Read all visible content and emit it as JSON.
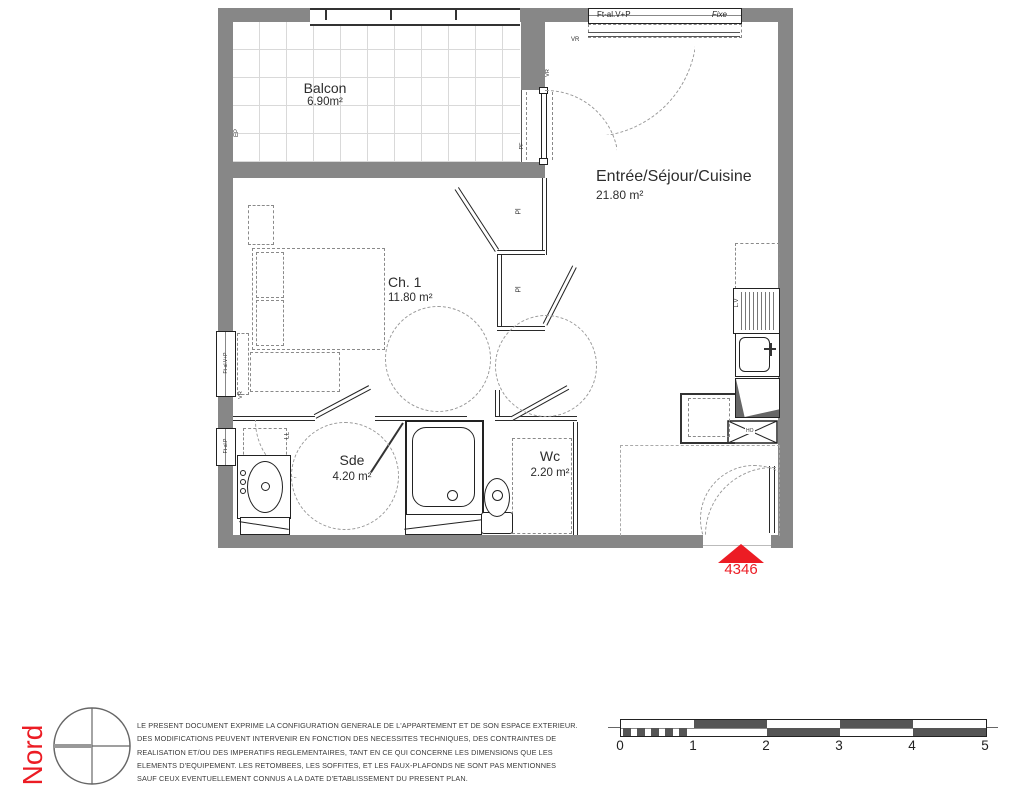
{
  "plan": {
    "rooms": [
      {
        "name": "Balcon",
        "area": "6.90m²"
      },
      {
        "name": "Entrée/Séjour/Cuisine",
        "area": "21.80 m²"
      },
      {
        "name": "Ch. 1",
        "area": "11.80 m²"
      },
      {
        "name": "Sde",
        "area": "4.20 m²"
      },
      {
        "name": "Wc",
        "area": "2.20 m²"
      }
    ],
    "labels": {
      "window_ftal_vp": "Ft-al.V+P",
      "window_fixe": "Fixe",
      "window_ftal_p": "Ft-al.P",
      "vr": "VR",
      "pf": "PF",
      "ep": "EP",
      "ll": "LL",
      "pl": "Pl",
      "lv": "L.V",
      "ho": "HO"
    },
    "unit_number": "4346"
  },
  "footer": {
    "north_label": "Nord",
    "disclaimer_lines": [
      "LE PRESENT DOCUMENT EXPRIME LA CONFIGURATION GENERALE DE L'APPARTEMENT ET DE SON ESPACE EXTERIEUR.",
      "DES MODIFICATIONS PEUVENT INTERVENIR EN FONCTION DES NECESSITES TECHNIQUES, DES CONTRAINTES DE",
      "REALISATION ET/OU DES IMPERATIFS REGLEMENTAIRES, TANT EN CE QUI CONCERNE LES DIMENSIONS QUE LES",
      "ELEMENTS D'EQUIPEMENT. LES RETOMBEES, LES SOFFITES, ET LES FAUX-PLAFONDS NE SONT PAS MENTIONNES",
      "SAUF CEUX EVENTUELLEMENT CONNUS A LA DATE D'ETABLISSEMENT DU PRESENT PLAN."
    ],
    "scale_labels": [
      "0",
      "1",
      "2",
      "3",
      "4",
      "5"
    ]
  },
  "colors": {
    "accent_red": "#ec1c24",
    "wall_gray": "#878787"
  }
}
